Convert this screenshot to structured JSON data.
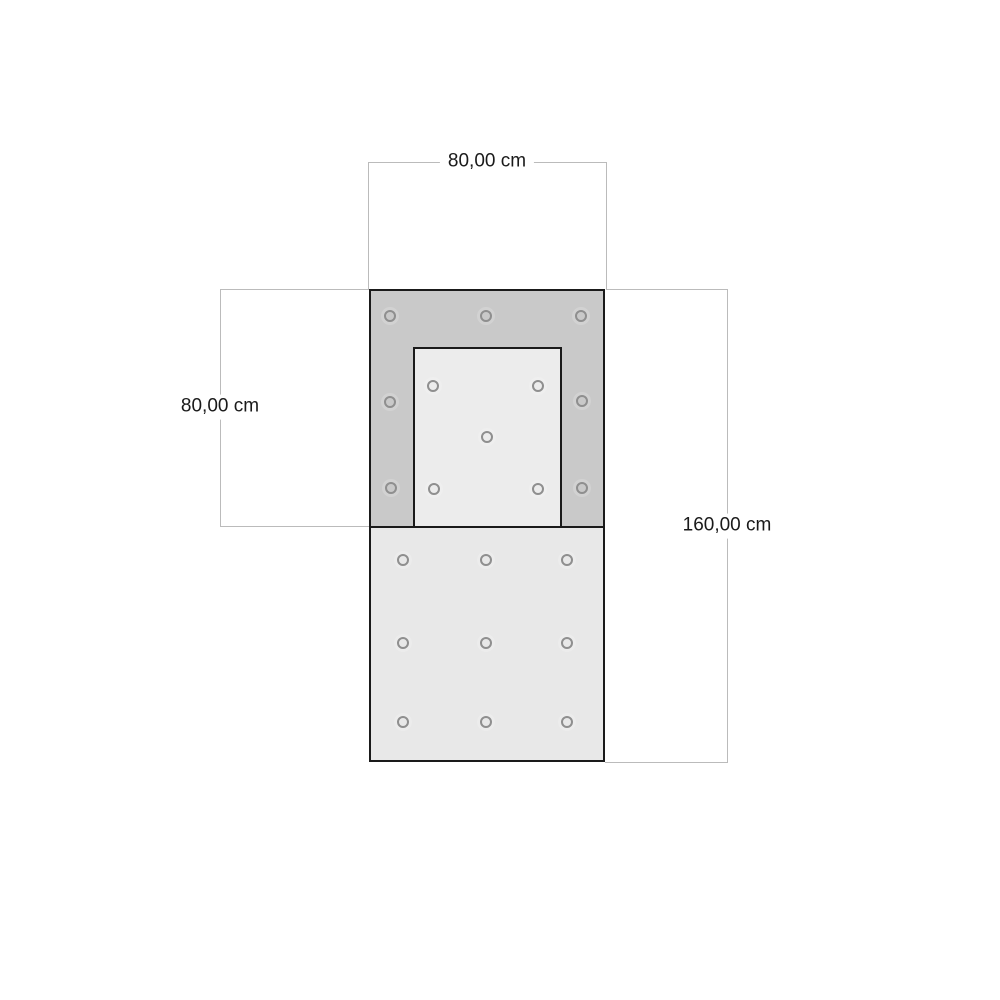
{
  "diagram": {
    "type": "dimension-drawing",
    "dimensions": {
      "top": {
        "label": "80,00 cm",
        "measures": "overall width"
      },
      "left": {
        "label": "80,00 cm",
        "measures": "upper section height"
      },
      "right": {
        "label": "160,00 cm",
        "measures": "overall height"
      }
    },
    "colors": {
      "frame_fill": "#c9c9c9",
      "inner_fill": "#ececec",
      "lower_fill": "#e8e8e8",
      "outline": "#1a1a1a",
      "dimension_line": "#bbbbbb",
      "hole_stroke": "#8f8f8f",
      "label_text": "#1a1a1a",
      "background": "#ffffff"
    },
    "holes": {
      "upper_frame": [
        [
          19,
          25
        ],
        [
          115,
          25
        ],
        [
          210,
          25
        ],
        [
          19,
          111
        ],
        [
          211,
          110
        ],
        [
          20,
          197
        ],
        [
          211,
          197
        ]
      ],
      "inner_panel": [
        [
          62,
          95
        ],
        [
          167,
          95
        ],
        [
          116,
          146
        ],
        [
          63,
          198
        ],
        [
          167,
          198
        ]
      ],
      "lower_panel": [
        [
          32,
          269
        ],
        [
          115,
          269
        ],
        [
          196,
          269
        ],
        [
          32,
          352
        ],
        [
          115,
          352
        ],
        [
          196,
          352
        ],
        [
          32,
          431
        ],
        [
          115,
          431
        ],
        [
          196,
          431
        ]
      ]
    }
  }
}
